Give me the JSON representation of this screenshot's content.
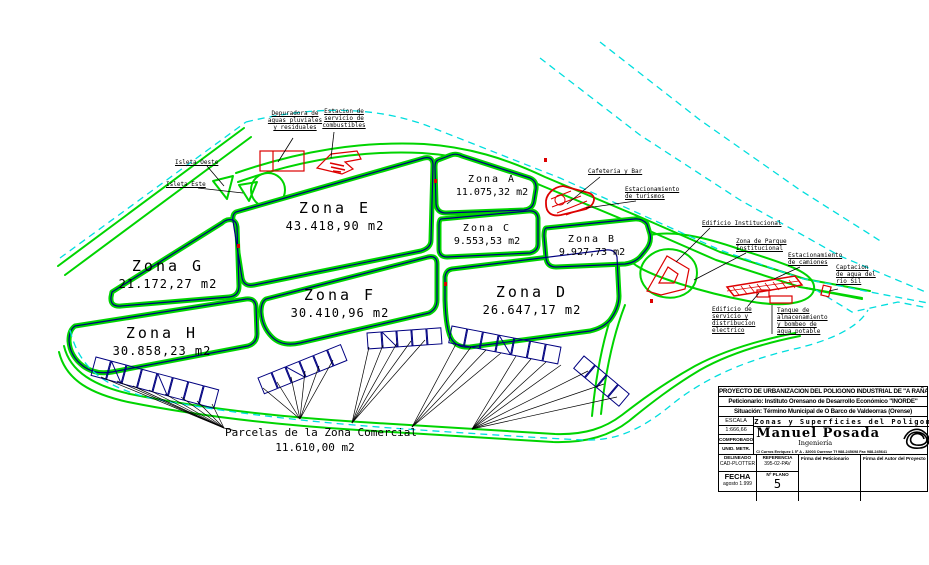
{
  "drawing": {
    "zones": [
      {
        "id": "E",
        "name": "Zona E",
        "area": "43.418,90 m2"
      },
      {
        "id": "G",
        "name": "Zona G",
        "area": "21.172,27 m2"
      },
      {
        "id": "H",
        "name": "Zona H",
        "area": "30.858,23 m2"
      },
      {
        "id": "F",
        "name": "Zona F",
        "area": "30.410,96 m2"
      },
      {
        "id": "D",
        "name": "Zona D",
        "area": "26.647,17 m2"
      },
      {
        "id": "A",
        "name": "Zona A",
        "area": "11.075,32 m2"
      },
      {
        "id": "C",
        "name": "Zona C",
        "area": "9.553,53 m2"
      },
      {
        "id": "B",
        "name": "Zona B",
        "area": "9.927,73 m2"
      }
    ],
    "annotations": {
      "depuradora": {
        "lines": [
          "Depuradora de",
          "aguas pluviales",
          "y residuales"
        ]
      },
      "estacion": {
        "lines": [
          "Estacion de",
          "servicio de",
          "combustibles"
        ]
      },
      "isleta_oeste": {
        "label": "Isleta Oeste"
      },
      "isleta_este": {
        "label": "Isleta Este"
      },
      "cafeteria": {
        "label": "Cafeteria y Bar"
      },
      "est_turismos": {
        "lines": [
          "Estacionamiento",
          "de turismos"
        ]
      },
      "edificio_institucional": {
        "label": "Edificio Institucional"
      },
      "parque": {
        "lines": [
          "Zona de Parque",
          "Institucional"
        ]
      },
      "est_camiones": {
        "lines": [
          "Estacionamiento",
          "de camiones"
        ]
      },
      "captacion": {
        "lines": [
          "Captacion",
          "de agua del",
          "rio Sil"
        ]
      },
      "edificio_servicio": {
        "lines": [
          "Edificio de",
          "servicio y",
          "distribucion",
          "electrico"
        ]
      },
      "tanque": {
        "lines": [
          "Tanque de",
          "almacenamiento",
          "y bombeo de",
          "agua potable"
        ]
      },
      "parcelas": {
        "lines": [
          "Parcelas de la Zona Comercial",
          "11.610,00 m2"
        ]
      }
    },
    "colors": {
      "road": "#00d400",
      "parcel": "#000080",
      "water": "#00dede",
      "building": "#dd0000",
      "text": "#000000"
    }
  },
  "tb": {
    "row1": "PROYECTO DE URBANIZACION DEL POLIGONO INDUSTRIAL DE \"A RAÑA\"",
    "row2": "Peticionario: Instituto Orensano de Desarrollo Económico \"INORDE\"",
    "row3": "Situación: Término Municipal de O Barco de Valdeorras (Orense)",
    "escala_label": "ESCALA",
    "escala_value": "1:666,66",
    "comprobado": "COMPROBADO",
    "unidades": "UNID. METR.",
    "plano_title": "Zonas y Superficies del Poligono",
    "firm_name": "Manuel Posada",
    "firm_sub": "Ingeniería",
    "firm_address": "C/ Curros Enriquez 1 5º A - 32003 Ourense Tf 988-245698 Fax 988-245641",
    "delineado_label": "DELINEADO",
    "delineado_value": "CAD-PLOTTER",
    "referencia_label": "REFERENCIA",
    "referencia_value": "395-02-PAV",
    "firma_peticionario": "Firma del Peticionario",
    "firma_autor": "Firma del Autor del Proyecto",
    "fecha_label": "FECHA",
    "fecha_value": "agosto 1.999",
    "num_plano_label": "Nº PLANO",
    "num_plano_value": "5"
  }
}
